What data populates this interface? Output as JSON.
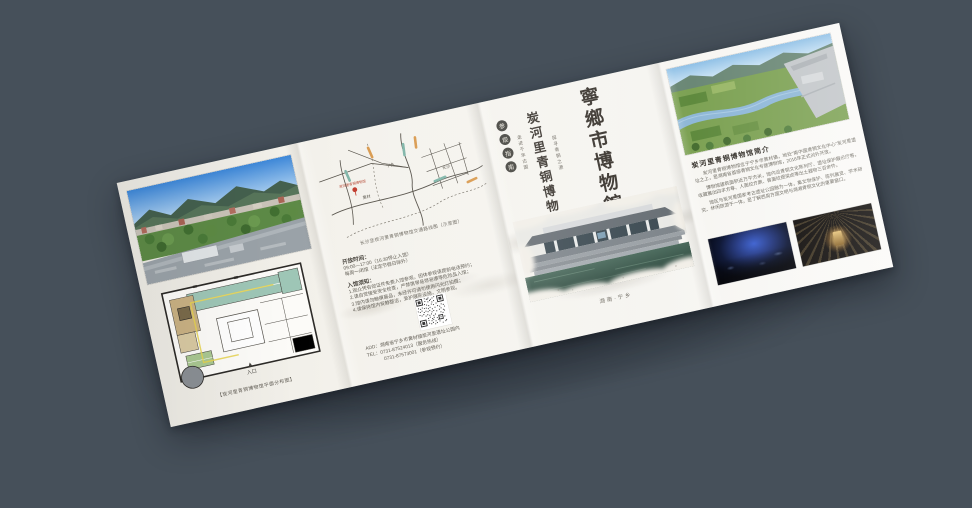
{
  "scene": {
    "background": "#46505a",
    "paper_color": "#f4f2ec",
    "accent_red": "#a8372a",
    "ink_color": "#3a352f"
  },
  "panel1": {
    "floorplan_caption": "【炭河里青铜博物馆平面分布图】",
    "entrance_label": "入口"
  },
  "panel2": {
    "map_caption": "长沙至炭河里青铜博物馆交通路线图（示意图）",
    "map_labels": {
      "pin": "炭河里青铜博物馆",
      "town1": "黄材",
      "town2": "宁乡",
      "town3": "长沙"
    },
    "hours_label": "开放时间：",
    "hours_line1": "09:00—17:00（16:30停止入馆）",
    "hours_line2": "每周一闭馆（法定节假日除外）",
    "notice_label": "入馆须知：",
    "notice_lines": [
      "1.观众凭有效证件免费入馆参观，团体参观请提前电话预约；",
      "2.请自觉接受安全检查，严禁携带易燃易爆等危险品入馆；",
      "3.馆内请勿触摸展品，未经许可请勿使用闪光灯拍摄；",
      "4.请保持馆内安静整洁，爱护展陈设施，文明参观。"
    ],
    "add_line": "ADD：湖南省宁乡市黄材镇炭河里遗址公园内",
    "tel_line1": "TEL：0731-87524013（服务热线）",
    "tel_line2": "0731-87573001（参观预约）"
  },
  "cover": {
    "badge_chars": [
      "参",
      "观",
      "指",
      "南"
    ],
    "tagline1": "走进千年古国",
    "title_sub": "炭河里青铜博物馆",
    "tagline2": "探寻青铜之源",
    "title_main": "寧鄉市博物館",
    "photo_caption": "湖南·宁乡"
  },
  "panel4": {
    "intro_title": "炭河里青铜博物馆简介",
    "paragraphs": [
      "炭河里青铜博物馆位于宁乡市黄材镇，地处“南中国青铜文化中心”炭河里遗址之上，是湖南省首座青铜文化专题博物馆，2016年正式对外开放。",
      "博物馆建筑面积近万平方米，馆内设青铜文化陈列厅、遗址保护展示厅等，收藏展出四羊方尊、人面纹方鼎、兽面纹提梁卣等出土器物三百余件。",
      "馆区与炭河里国家考古遗址公园融为一体，集文物保护、陈列展览、学术研究、休闲旅游于一体，是了解西周方国文明与湖湘青铜文化的重要窗口。"
    ]
  }
}
